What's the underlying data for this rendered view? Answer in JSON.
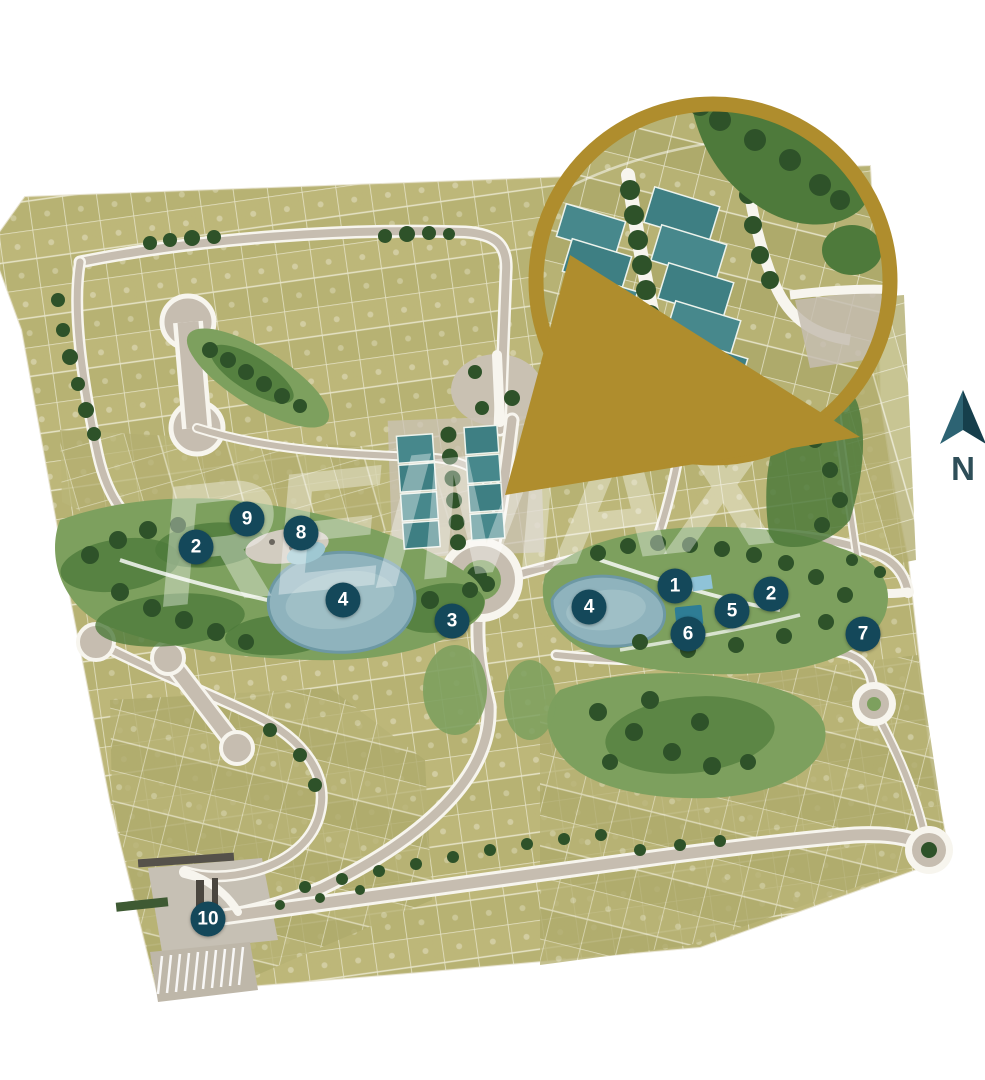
{
  "page": {
    "background": "#FFFFFF"
  },
  "watermark": {
    "text": "RE/MAX",
    "registered": "®"
  },
  "north_indicator": {
    "label": "N"
  },
  "markers": [
    {
      "id": "2-west-park",
      "label": "2",
      "x": 196,
      "y": 547
    },
    {
      "id": "9",
      "label": "9",
      "x": 247,
      "y": 519
    },
    {
      "id": "8",
      "label": "8",
      "x": 301,
      "y": 533
    },
    {
      "id": "4-west-lake",
      "label": "4",
      "x": 343,
      "y": 600
    },
    {
      "id": "3",
      "label": "3",
      "x": 452,
      "y": 621
    },
    {
      "id": "4-east-lake",
      "label": "4",
      "x": 589,
      "y": 607
    },
    {
      "id": "1",
      "label": "1",
      "x": 675,
      "y": 586
    },
    {
      "id": "2-east-park",
      "label": "2",
      "x": 771,
      "y": 594
    },
    {
      "id": "5",
      "label": "5",
      "x": 732,
      "y": 611
    },
    {
      "id": "6",
      "label": "6",
      "x": 688,
      "y": 634
    },
    {
      "id": "7",
      "label": "7",
      "x": 863,
      "y": 634
    },
    {
      "id": "10-entrance",
      "label": "10",
      "x": 208,
      "y": 919
    }
  ],
  "amenity_highlight": {
    "x": 689,
    "y": 616
  },
  "colors": {
    "accent_gold": "#AF8D2D",
    "marker_teal": "#14485A",
    "featured_lot_teal": "#47888C",
    "lot_olive": "#B7B273",
    "park_green": "#7DA05E",
    "park_green_dark": "#4E7A3B",
    "tree_green": "#2E5229",
    "pond_blue": "#8FB3BD",
    "road_tan": "#C6BDB0",
    "road_white": "#F7F5EE"
  }
}
